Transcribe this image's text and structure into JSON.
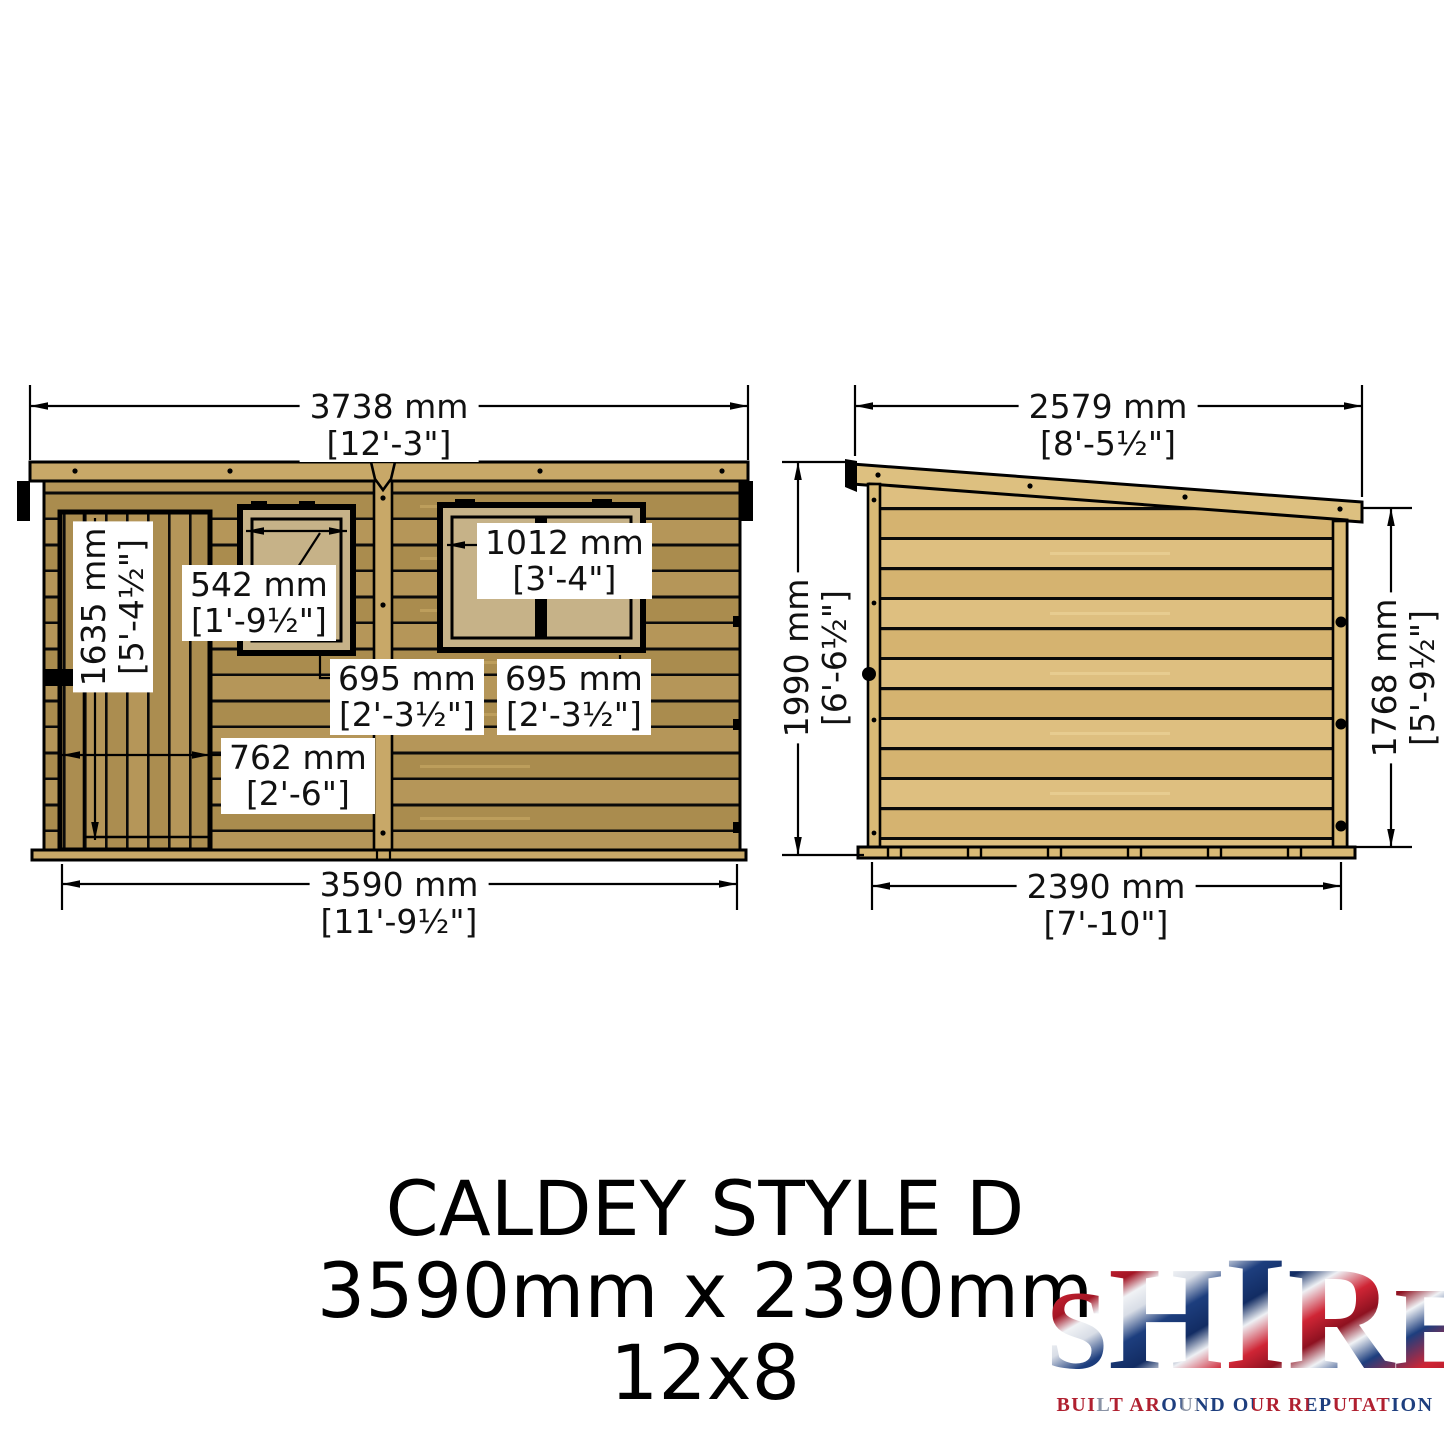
{
  "front_view": {
    "overall_width_top": {
      "mm": "3738 mm",
      "imperial": "[12'-3\"]"
    },
    "overall_width_bottom": {
      "mm": "3590 mm",
      "imperial": "[11'-9½\"]"
    },
    "door_height": {
      "mm": "1635 mm",
      "imperial": "[5'-4½\"]"
    },
    "door_width": {
      "mm": "762 mm",
      "imperial": "[2'-6\"]"
    },
    "window1_width": {
      "mm": "542 mm",
      "imperial": "[1'-9½\"]"
    },
    "window2_width": {
      "mm": "1012 mm",
      "imperial": "[3'-4\"]"
    },
    "window1_height": {
      "mm": "695 mm",
      "imperial": "[2'-3½\"]"
    },
    "window2_height": {
      "mm": "695 mm",
      "imperial": "[2'-3½\"]"
    }
  },
  "side_view": {
    "overall_depth_top": {
      "mm": "2579 mm",
      "imperial": "[8'-5½\"]"
    },
    "overall_depth_bottom": {
      "mm": "2390 mm",
      "imperial": "[7'-10\"]"
    },
    "height_left": {
      "mm": "1990 mm",
      "imperial": "[6'-6½\"]"
    },
    "height_right": {
      "mm": "1768 mm",
      "imperial": "[5'-9½\"]"
    }
  },
  "title": {
    "line1": "CALDEY STYLE D",
    "line2": "3590mm x 2390mm",
    "line3": "12x8"
  },
  "logo": {
    "name": "SHIRE",
    "letters": [
      "S",
      "H",
      "I",
      "R",
      "E"
    ],
    "tagline": "BUILT AROUND OUR REPUTATION"
  },
  "colors": {
    "front_wood": "#b59659",
    "front_wood_dark": "#aa8c4e",
    "side_wood": "#debf80",
    "side_wood_dark": "#d5b370",
    "trim_wood": "#c8a868",
    "window_glass": "#c6b288",
    "outline": "#000000",
    "logo_red": "#cf2535",
    "logo_blue": "#1d3e7e"
  }
}
